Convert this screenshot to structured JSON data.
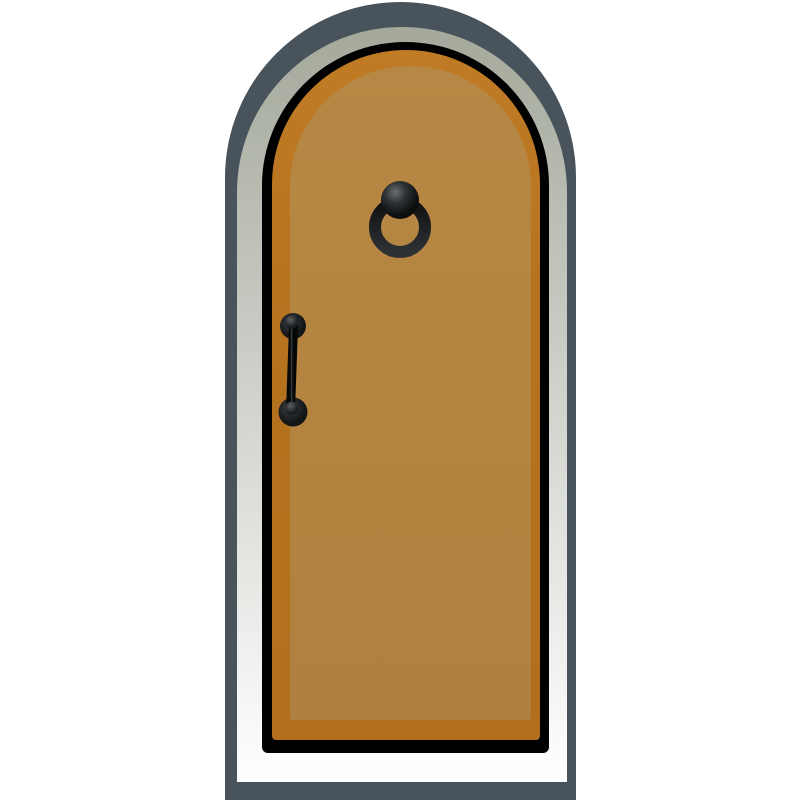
{
  "illustration": {
    "subject": "arched-door-clipart",
    "background_color": "#ffffff"
  },
  "door": {
    "outer_frame_color": "#48535b",
    "inner_frame_top_color": "#a4a99b",
    "inner_frame_bottom_color": "#ffffff",
    "outline_color": "#000000",
    "panel_color": "#b5721f",
    "panel_highlight_color": "#c07b25",
    "inset_panel_color": "#b3833f",
    "inset_panel_highlight_color": "#b78745"
  },
  "hardware": {
    "base_color": "#0b0c0d",
    "mid_color": "#2e3234",
    "highlight_color": "#6a6f71",
    "knob_highlight_color": "#5c6163",
    "ring_top_color": "#0e1012",
    "ring_bottom_color": "#2e3133",
    "rod_highlight_color": "#44484a"
  }
}
